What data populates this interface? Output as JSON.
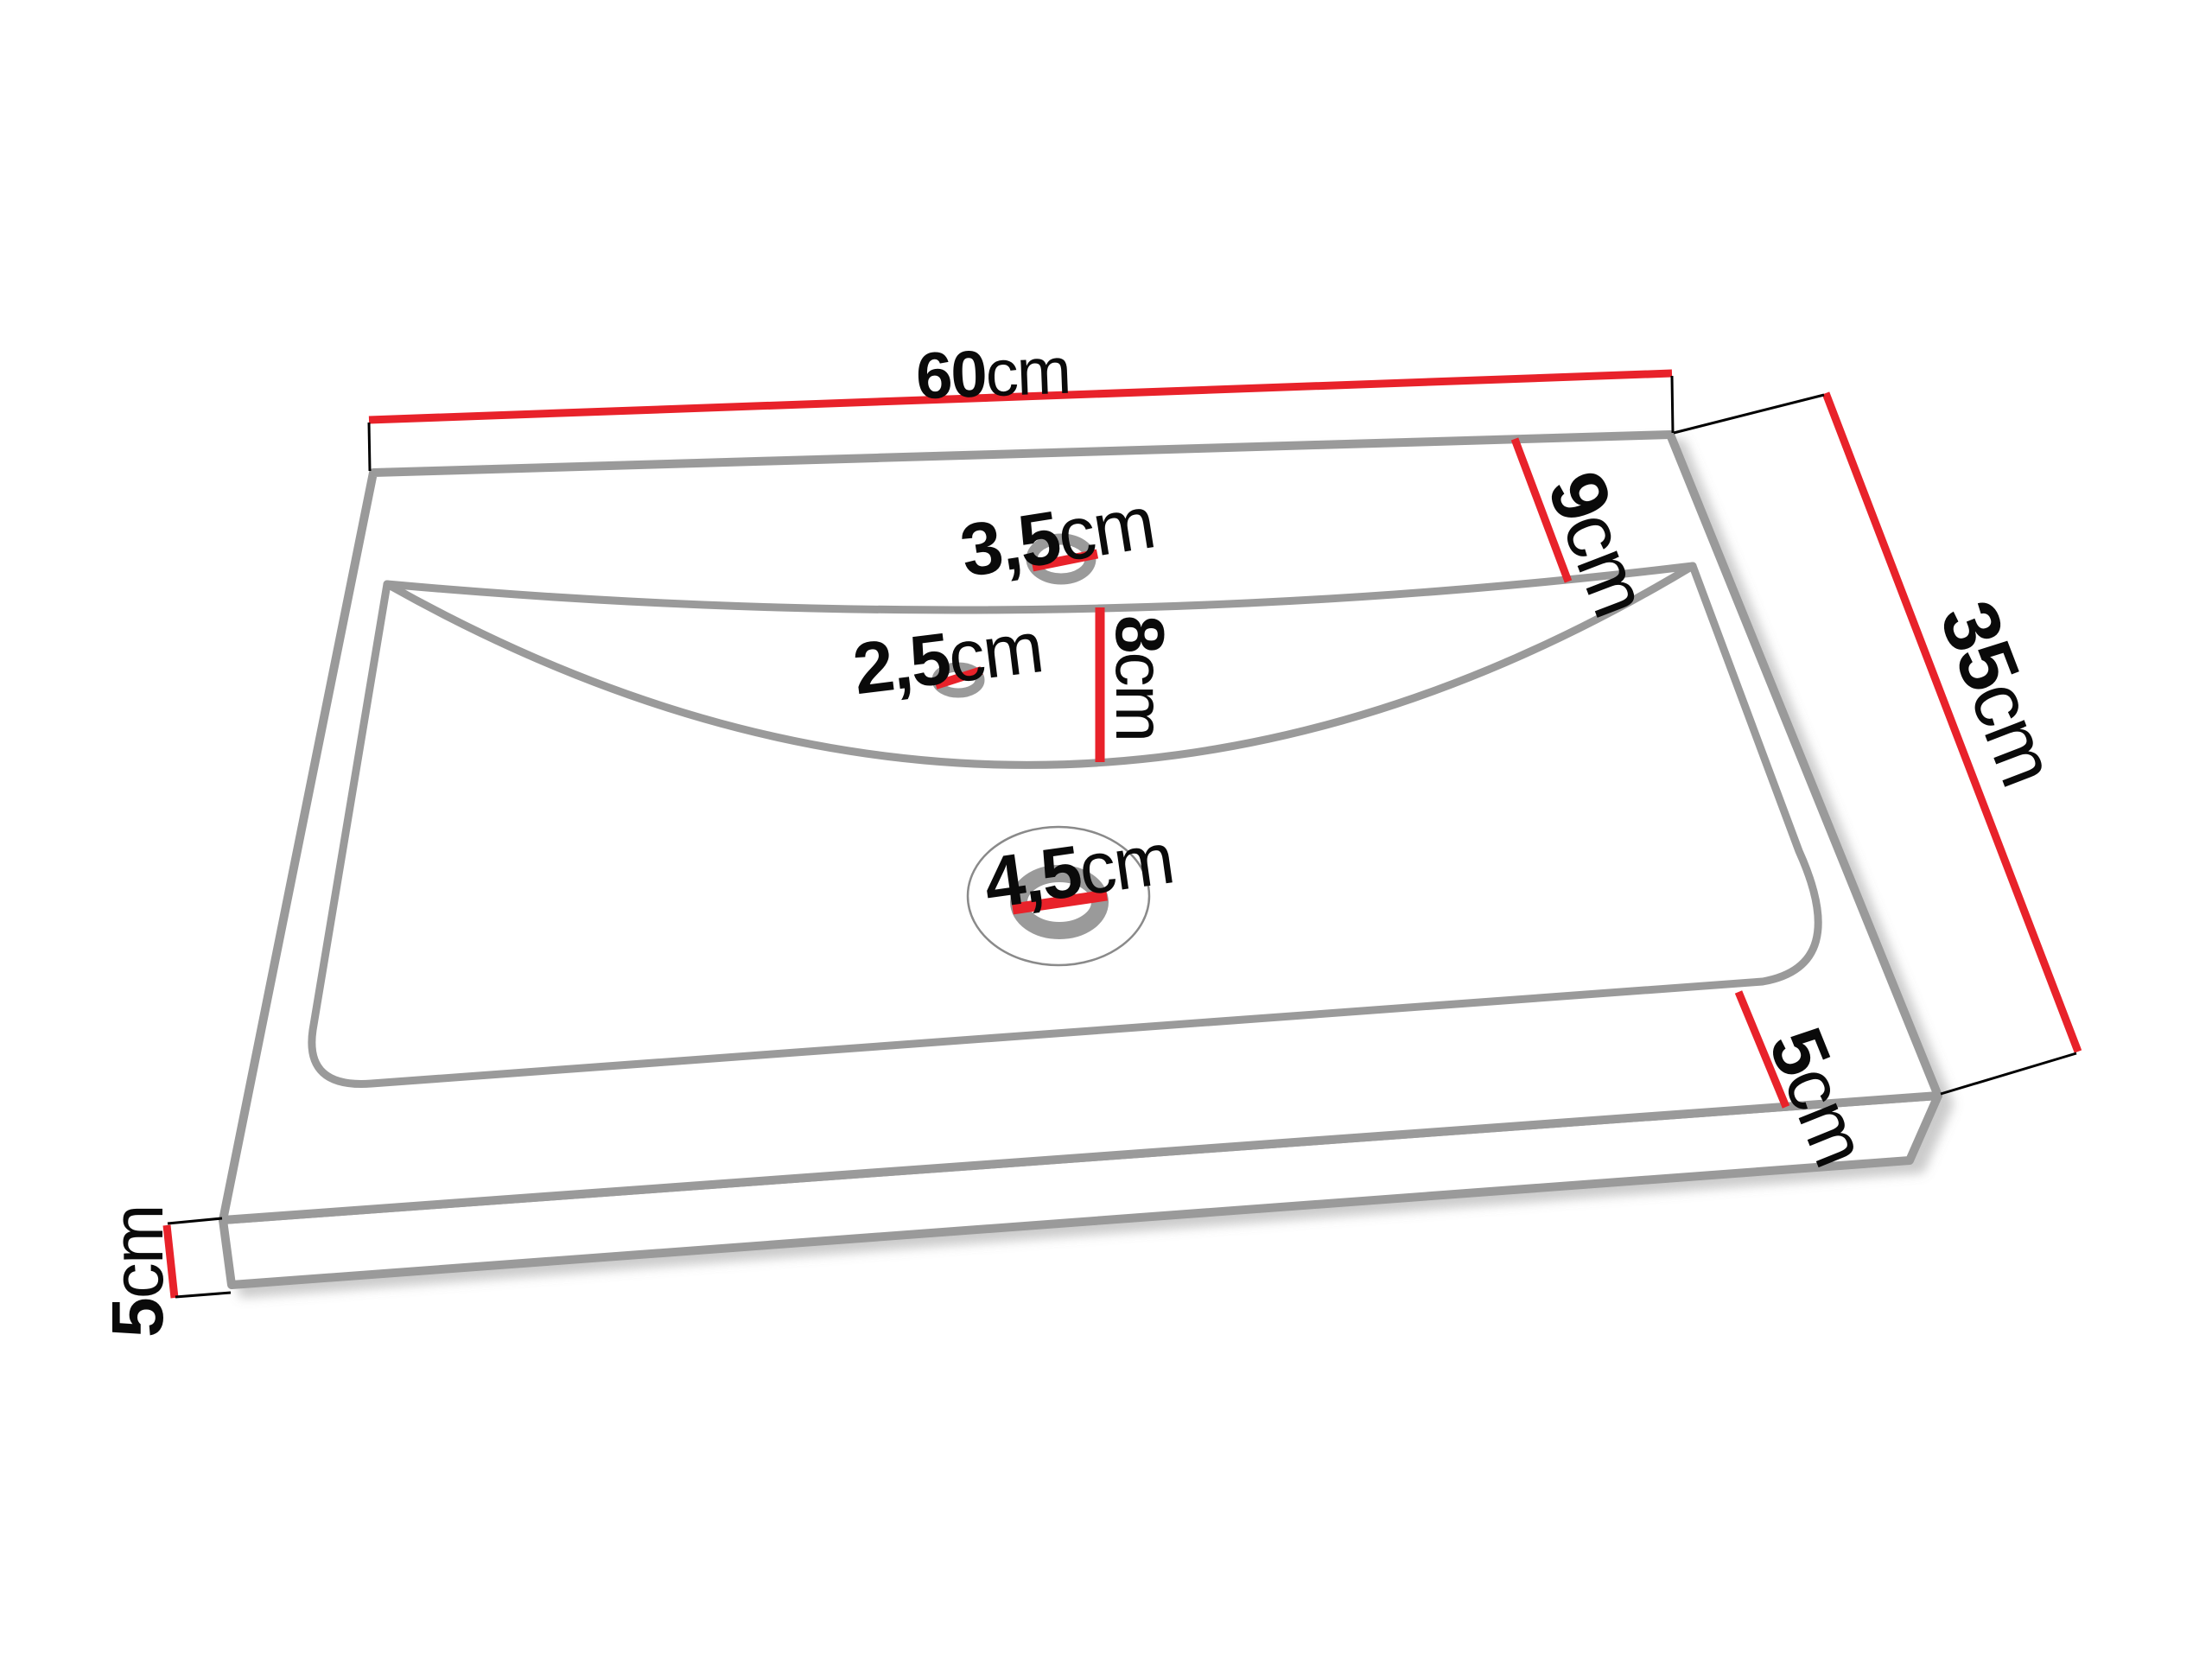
{
  "diagram": {
    "type": "technical-dimension-drawing",
    "subject": "washbasin perspective view with dimension callouts",
    "background_color": "#ffffff",
    "colors": {
      "outline_gray": "#9a9a9a",
      "dimension_red": "#e8222a",
      "tick_black": "#000000",
      "text_black": "#0a0a0a"
    },
    "unit": "cm",
    "dimensions": {
      "overall_width": {
        "num": "60",
        "unit": "cm"
      },
      "overall_depth": {
        "num": "35",
        "unit": "cm"
      },
      "back_deck_depth": {
        "num": "9",
        "unit": "cm"
      },
      "basin_wall_drop": {
        "num": "8",
        "unit": "cm"
      },
      "faucet_hole": {
        "num": "3,5",
        "unit": "cm"
      },
      "overflow_hole": {
        "num": "2,5",
        "unit": "cm"
      },
      "drain_hole": {
        "num": "4,5",
        "unit": "cm"
      },
      "front_rim_width": {
        "num": "5",
        "unit": "cm"
      },
      "slab_thickness": {
        "num": "5",
        "unit": "cm"
      }
    }
  }
}
